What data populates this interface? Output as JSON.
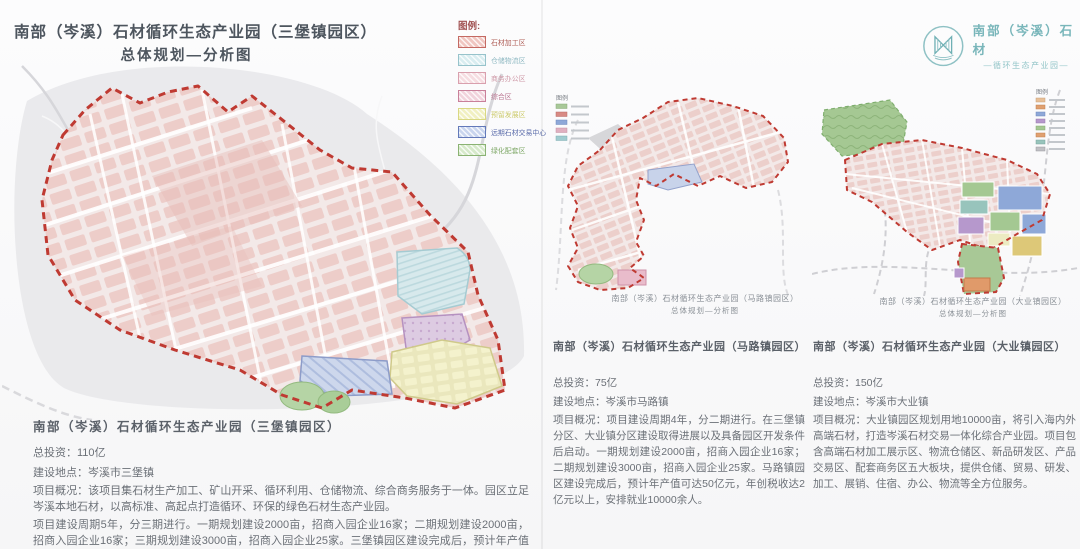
{
  "left_panel": {
    "title_line1": "南部（岑溪）石材循环生态产业园（三堡镇园区）",
    "title_line2": "总体规划—分析图",
    "legend": {
      "header": "图例:",
      "items": [
        {
          "label": "石材加工区",
          "fill": "#f0c6c1",
          "border": "#c46a63",
          "text_color": "#b06058"
        },
        {
          "label": "仓储物流区",
          "fill": "#d9edf0",
          "border": "#97c3cb",
          "text_color": "#8fb9c2"
        },
        {
          "label": "商务办公区",
          "fill": "#f6dde1",
          "border": "#d9a0ae",
          "text_color": "#cf9aa8"
        },
        {
          "label": "综合区",
          "fill": "#f1d3dc",
          "border": "#c9809a",
          "text_color": "#ba7490"
        },
        {
          "label": "预留发展区",
          "fill": "#f1f0c2",
          "border": "#d9d883",
          "text_color": "#cdcb6d"
        },
        {
          "label": "远期石材交易中心",
          "fill": "#c9d5ee",
          "border": "#6379b9",
          "text_color": "#5b6cab"
        },
        {
          "label": "绿化配套区",
          "fill": "#d6e9ca",
          "border": "#8ab273",
          "text_color": "#80a96a"
        }
      ]
    },
    "info": {
      "heading": "南部（岑溪）石材循环生态产业园（三堡镇园区）",
      "investment_label": "总投资：",
      "investment_value": "110亿",
      "location_label": "建设地点：",
      "location_value": "岑溪市三堡镇",
      "overview": "项目概况：该项目集石材生产加工、矿山开采、循环利用、仓储物流、综合商务服务于一体。园区立足岑溪本地石材，以高标准、高起点打造循环、环保的绿色石材生态产业园。",
      "phases": "项目建设周期5年，分三期进行。一期规划建设2000亩，招商入园企业16家；二期规划建设2000亩，招商入园企业16家；三期规划建设3000亩，招商入园企业25家。三堡镇园区建设完成后，预计年产值可达80亿元，年创税收达2.5亿元以上，安排就业15000余人。"
    }
  },
  "middle_panel": {
    "mini_legend_header": "图例",
    "map_caption_line1": "南部（岑溪）石材循环生态产业园（马路镇园区）",
    "map_caption_line2": "总体规划—分析图",
    "info": {
      "heading": "南部（岑溪）石材循环生态产业园（马路镇园区）",
      "investment_label": "总投资：",
      "investment_value": "75亿",
      "location_label": "建设地点：",
      "location_value": "岑溪市马路镇",
      "overview": "项目概况：项目建设周期4年，分二期进行。在三堡镇分区、大业镇分区建设取得进展以及具备园区开发条件后启动。一期规划建设2000亩，招商入园企业16家；二期规划建设3000亩，招商入园企业25家。马路镇园区建设完成后，预计年产值可达50亿元，年创税收达2亿元以上，安排就业10000余人。"
    }
  },
  "right_panel": {
    "logo_line1": "南部（岑溪）石材",
    "logo_line2": "—循环生态产业园—",
    "mini_legend_header": "图例",
    "map_caption_line1": "南部（岑溪）石材循环生态产业园（大业镇园区）",
    "map_caption_line2": "总体规划—分析图",
    "info": {
      "heading": "南部（岑溪）石材循环生态产业园（大业镇园区）",
      "investment_label": "总投资：",
      "investment_value": "150亿",
      "location_label": "建设地点：",
      "location_value": "岑溪市大业镇",
      "overview": "项目概况：大业镇园区规划用地10000亩，将引入海内外高端石材，打造岑溪石材交易一体化综合产业园。项目包含高端石材加工展示区、物流仓储区、新品研发区、产品交易区、配套商务区五大板块，提供仓储、贸易、研发、加工、展销、住宿、办公、物流等全方位服务。"
    }
  },
  "colors": {
    "boundary_red": "#bf3a32",
    "block_pink": "#edcdc9",
    "terrain_gray": "#e6e6e9",
    "logo_teal": "#79b6ba"
  }
}
